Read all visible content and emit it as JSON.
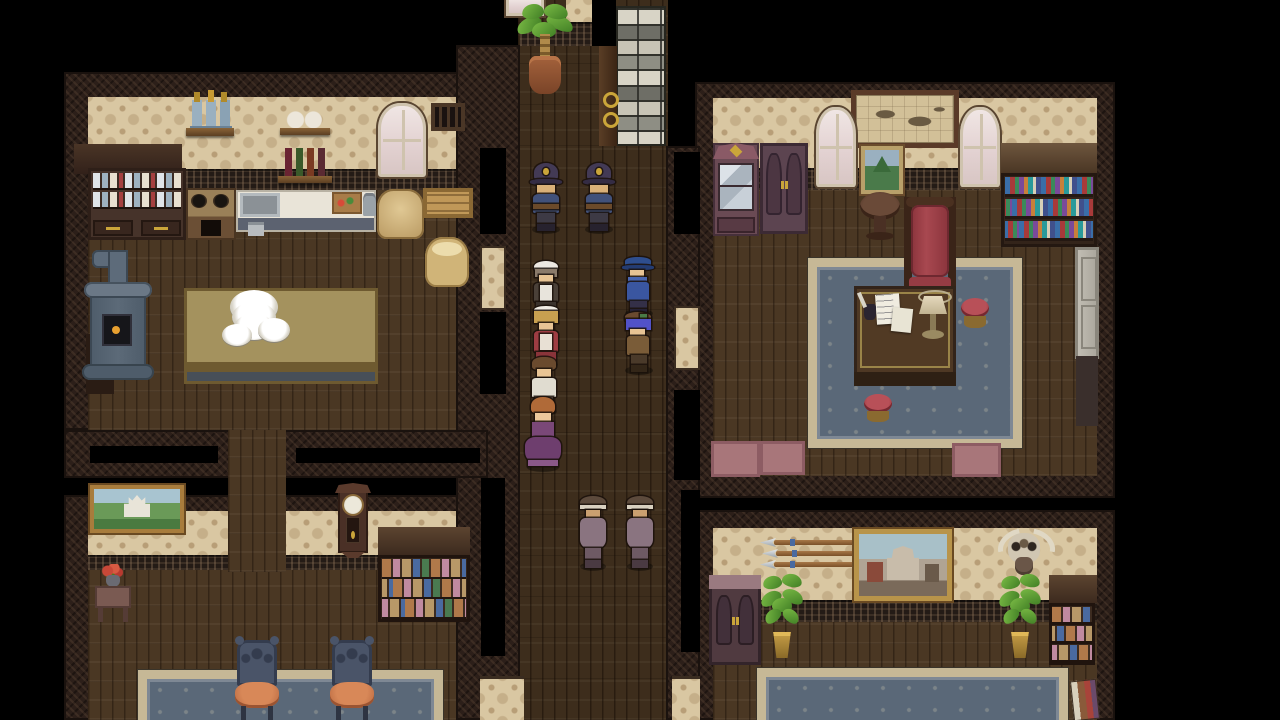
{
  "meta": {
    "app": "retro-rpg-game",
    "scene": "manor-interior-investigation",
    "viewport": "1280x720 fullscreen, no HUD text visible"
  },
  "palette": {
    "letterbox": "#000000",
    "wall_frame": "#2c1f19",
    "wallpaper": "#d9c7a2",
    "wainscot": "#241b16",
    "room_floor": "#4a3723",
    "corridor_floor": "#3d2d1c",
    "rug_blue": "#5a6878",
    "rug_border": "#c6b896",
    "counter_white": "#e9e4d8",
    "table_khaki": "#9c8a58",
    "uniform_navy": "#41517a",
    "detective_blue": "#3a56a0",
    "maid_red": "#9e3c42",
    "gown_purple": "#6e3e6e",
    "cloak_mauve": "#8a7480",
    "brick_light": "#d8d4c6",
    "brick_dark": "#8e8e84",
    "plant_green": "#5aa032",
    "accent_gold": "#caa53a"
  },
  "rooms": [
    {
      "id": "kitchen",
      "label": "kitchen (top-left)"
    },
    {
      "id": "study",
      "label": "study / library (top-right)"
    },
    {
      "id": "dining-room",
      "label": "dining room (bottom-left)"
    },
    {
      "id": "trophy-room",
      "label": "trophy room (bottom-right)"
    },
    {
      "id": "corridor",
      "label": "central corridor"
    }
  ],
  "furniture_inventory": {
    "kitchen": [
      "dish hutch with drawers",
      "wall shelf with jars",
      "wall shelf with pots",
      "wall shelf with wine bottles",
      "arched window",
      "wall vent",
      "stove with burners",
      "counter with sink",
      "cutting board",
      "grain sacks",
      "wooden crate",
      "iron furnace with pipe",
      "large table with plate stacks"
    ],
    "study": [
      "framed wall map",
      "small mountain painting",
      "two arched windows",
      "glass display cabinet",
      "wardrobe",
      "round side table",
      "red high-back chair",
      "bookshelf with books",
      "blue ornate rug",
      "writing desk with papers, ink and lamp",
      "two red stools",
      "grey side door with dark mat",
      "three pink floor mats"
    ],
    "dining-room": [
      "castle painting",
      "grandfather wall clock",
      "toy shelf",
      "side table with red flowers",
      "blue ornate rug",
      "two chairs with orange seats"
    ],
    "trophy-room": [
      "three mounted spears",
      "framed city painting",
      "bull skull trophy",
      "small cabinet",
      "two potted plants",
      "small goods shelf",
      "blue ornate rug",
      "book stack"
    ],
    "corridor": [
      "potted palm",
      "stone brick column",
      "door frame with gold rings"
    ]
  },
  "characters": [
    {
      "id": "police-officer-1",
      "role": "police officer with custodian helmet",
      "x": 528,
      "y": 163,
      "w": 36,
      "h": 68,
      "facing": "down",
      "parts": [
        {
          "name": "helmet",
          "l": 16,
          "t": 0,
          "w": 68,
          "h": 28,
          "c": "#433a55",
          "r": "50% 50% 30% 30%"
        },
        {
          "name": "helmet-brim",
          "l": 5,
          "t": 24,
          "w": 90,
          "h": 9,
          "c": "#342c44",
          "r": "40%"
        },
        {
          "name": "badge",
          "l": 42,
          "t": 7,
          "w": 16,
          "h": 11,
          "c": "#caa53a",
          "r": "50%"
        },
        {
          "name": "face",
          "l": 26,
          "t": 33,
          "w": 48,
          "h": 12,
          "c": "#d9b078"
        },
        {
          "name": "torso",
          "l": 14,
          "t": 45,
          "w": 72,
          "h": 28,
          "c": "#41517a",
          "r": "22% 22% 8% 8%"
        },
        {
          "name": "belt",
          "l": 14,
          "t": 61,
          "w": 72,
          "h": 7,
          "c": "#6b4a2a"
        },
        {
          "name": "legs",
          "l": 25,
          "t": 73,
          "w": 50,
          "h": 18,
          "c": "#3d3a45"
        },
        {
          "name": "boots",
          "l": 25,
          "t": 90,
          "w": 50,
          "h": 10,
          "c": "#27222e"
        }
      ]
    },
    {
      "id": "police-officer-2",
      "role": "police officer with custodian helmet",
      "x": 581,
      "y": 163,
      "w": 36,
      "h": 68,
      "facing": "down",
      "parts": [
        {
          "name": "helmet",
          "l": 16,
          "t": 0,
          "w": 68,
          "h": 28,
          "c": "#433a55",
          "r": "50% 50% 30% 30%"
        },
        {
          "name": "helmet-brim",
          "l": 5,
          "t": 24,
          "w": 90,
          "h": 9,
          "c": "#342c44",
          "r": "40%"
        },
        {
          "name": "badge",
          "l": 42,
          "t": 7,
          "w": 16,
          "h": 11,
          "c": "#caa53a",
          "r": "50%"
        },
        {
          "name": "face",
          "l": 26,
          "t": 33,
          "w": 48,
          "h": 12,
          "c": "#d9b078"
        },
        {
          "name": "torso",
          "l": 14,
          "t": 45,
          "w": 72,
          "h": 28,
          "c": "#41517a",
          "r": "22% 22% 8% 8%"
        },
        {
          "name": "belt",
          "l": 14,
          "t": 61,
          "w": 72,
          "h": 7,
          "c": "#6b4a2a"
        },
        {
          "name": "legs",
          "l": 25,
          "t": 73,
          "w": 50,
          "h": 18,
          "c": "#3d3a45"
        },
        {
          "name": "boots",
          "l": 25,
          "t": 90,
          "w": 50,
          "h": 10,
          "c": "#27222e"
        }
      ]
    },
    {
      "id": "head-maid",
      "role": "older maid with white bonnet",
      "x": 530,
      "y": 261,
      "w": 32,
      "h": 53,
      "facing": "down",
      "parts": [
        {
          "name": "bonnet",
          "l": 12,
          "t": 0,
          "w": 76,
          "h": 22,
          "c": "#ece8e2",
          "r": "50% 50% 40% 40%"
        },
        {
          "name": "hair",
          "l": 16,
          "t": 16,
          "w": 68,
          "h": 15,
          "c": "#8a7a6a"
        },
        {
          "name": "face",
          "l": 28,
          "t": 27,
          "w": 44,
          "h": 14,
          "c": "#e8c494"
        },
        {
          "name": "dress",
          "l": 13,
          "t": 42,
          "w": 74,
          "h": 36,
          "c": "#4a4038",
          "r": "18% 18% 8% 8%"
        },
        {
          "name": "apron",
          "l": 30,
          "t": 46,
          "w": 40,
          "h": 30,
          "c": "#e8e4dc"
        },
        {
          "name": "hem",
          "l": 20,
          "t": 78,
          "w": 60,
          "h": 17,
          "c": "#3a322c"
        }
      ]
    },
    {
      "id": "detective",
      "role": "detective in blue coat and fedora",
      "x": 621,
      "y": 257,
      "w": 36,
      "h": 58,
      "facing": "left",
      "parts": [
        {
          "name": "hat-top",
          "l": 12,
          "t": 0,
          "w": 72,
          "h": 16,
          "c": "#2e4e8e",
          "r": "45% 45% 0 0"
        },
        {
          "name": "hat-brim",
          "l": 2,
          "t": 14,
          "w": 90,
          "h": 8,
          "c": "#243c72",
          "r": "40%"
        },
        {
          "name": "face",
          "l": 24,
          "t": 23,
          "w": 40,
          "h": 13,
          "c": "#e8c494"
        },
        {
          "name": "scarf",
          "l": 20,
          "t": 35,
          "w": 52,
          "h": 10,
          "c": "#4a66b0"
        },
        {
          "name": "coat",
          "l": 16,
          "t": 43,
          "w": 62,
          "h": 33,
          "c": "#3a56a0",
          "r": "15% 15% 10% 10%"
        },
        {
          "name": "legs",
          "l": 26,
          "t": 76,
          "w": 46,
          "h": 15,
          "c": "#343048"
        },
        {
          "name": "boots",
          "l": 26,
          "t": 89,
          "w": 46,
          "h": 11,
          "c": "#262236"
        }
      ]
    },
    {
      "id": "blonde-maid",
      "role": "young maid in crimson uniform",
      "x": 530,
      "y": 306,
      "w": 32,
      "h": 60,
      "facing": "down",
      "parts": [
        {
          "name": "frill",
          "l": 14,
          "t": 0,
          "w": 72,
          "h": 13,
          "c": "#f0ece4",
          "r": "50%"
        },
        {
          "name": "hair",
          "l": 14,
          "t": 8,
          "w": 72,
          "h": 20,
          "c": "#c8a050"
        },
        {
          "name": "face",
          "l": 28,
          "t": 28,
          "w": 44,
          "h": 13,
          "c": "#e8c494"
        },
        {
          "name": "dress",
          "l": 14,
          "t": 42,
          "w": 72,
          "h": 34,
          "c": "#9e3c42",
          "r": "18% 18% 8% 8%"
        },
        {
          "name": "apron",
          "l": 32,
          "t": 46,
          "w": 36,
          "h": 27,
          "c": "#e8e0d4"
        },
        {
          "name": "hem",
          "l": 18,
          "t": 76,
          "w": 64,
          "h": 18,
          "c": "#8a343a"
        }
      ]
    },
    {
      "id": "blue-haired-boy",
      "role": "boy with blue hair, brown cap and jacket",
      "x": 621,
      "y": 312,
      "w": 36,
      "h": 60,
      "facing": "left",
      "parts": [
        {
          "name": "cap",
          "l": 12,
          "t": 0,
          "w": 72,
          "h": 16,
          "c": "#6a4a30",
          "r": "50% 50% 20% 20%"
        },
        {
          "name": "cap-patch",
          "l": 52,
          "t": 4,
          "w": 20,
          "h": 8,
          "c": "#4a7a46"
        },
        {
          "name": "hair",
          "l": 14,
          "t": 12,
          "w": 70,
          "h": 18,
          "c": "#5252c8"
        },
        {
          "name": "face",
          "l": 26,
          "t": 28,
          "w": 40,
          "h": 12,
          "c": "#e8c494"
        },
        {
          "name": "jacket",
          "l": 18,
          "t": 40,
          "w": 60,
          "h": 32,
          "c": "#7a5c38",
          "r": "15% 15% 8% 8%"
        },
        {
          "name": "legs",
          "l": 28,
          "t": 72,
          "w": 44,
          "h": 18,
          "c": "#4a3a2a"
        },
        {
          "name": "boots",
          "l": 28,
          "t": 89,
          "w": 44,
          "h": 11,
          "c": "#332618"
        }
      ]
    },
    {
      "id": "butler-man",
      "role": "man with brown hair and white shirt",
      "x": 527,
      "y": 357,
      "w": 34,
      "h": 56,
      "facing": "down",
      "parts": [
        {
          "name": "hair",
          "l": 16,
          "t": 0,
          "w": 68,
          "h": 24,
          "c": "#6a4a2e",
          "r": "45% 45% 25% 25%"
        },
        {
          "name": "face",
          "l": 28,
          "t": 22,
          "w": 44,
          "h": 14,
          "c": "#e8c494"
        },
        {
          "name": "shirt",
          "l": 14,
          "t": 38,
          "w": 72,
          "h": 34,
          "c": "#e0dcd0",
          "r": "15% 15% 5% 5%"
        },
        {
          "name": "legs",
          "l": 24,
          "t": 72,
          "w": 52,
          "h": 20,
          "c": "#4a3a30"
        }
      ]
    },
    {
      "id": "lady-purple-gown",
      "role": "lady with auburn updo in purple gown",
      "x": 522,
      "y": 397,
      "w": 42,
      "h": 72,
      "facing": "down",
      "parts": [
        {
          "name": "hair",
          "l": 22,
          "t": 0,
          "w": 56,
          "h": 24,
          "c": "#b06a38",
          "r": "50% 50% 30% 30%"
        },
        {
          "name": "face",
          "l": 30,
          "t": 22,
          "w": 40,
          "h": 13,
          "c": "#ecc89c"
        },
        {
          "name": "bodice",
          "l": 24,
          "t": 35,
          "w": 52,
          "h": 22,
          "c": "#7a4878"
        },
        {
          "name": "skirt",
          "l": 8,
          "t": 55,
          "w": 84,
          "h": 40,
          "c": "#6e3e6e",
          "r": "30% 30% 45% 45%"
        },
        {
          "name": "skirt-trim",
          "l": 14,
          "t": 88,
          "w": 72,
          "h": 8,
          "c": "#8a5888"
        }
      ]
    },
    {
      "id": "cloaked-figure-1",
      "role": "cloaked figure with banded hat",
      "x": 576,
      "y": 496,
      "w": 34,
      "h": 72,
      "facing": "down",
      "parts": [
        {
          "name": "hat",
          "l": 12,
          "t": 0,
          "w": 76,
          "h": 18,
          "c": "#5c4a3c",
          "r": "50% 50% 30% 30%"
        },
        {
          "name": "hat-band",
          "l": 12,
          "t": 13,
          "w": 76,
          "h": 5,
          "c": "#d8d0c0"
        },
        {
          "name": "face",
          "l": 28,
          "t": 19,
          "w": 44,
          "h": 11,
          "c": "#caa070"
        },
        {
          "name": "cloak",
          "l": 12,
          "t": 30,
          "w": 76,
          "h": 42,
          "c": "#8a7480",
          "r": "20% 20% 28% 28%"
        },
        {
          "name": "legs",
          "l": 26,
          "t": 72,
          "w": 48,
          "h": 18,
          "c": "#6e5a64"
        },
        {
          "name": "boots",
          "l": 26,
          "t": 89,
          "w": 48,
          "h": 11,
          "c": "#4a3a42"
        }
      ]
    },
    {
      "id": "cloaked-figure-2",
      "role": "cloaked figure with banded hat",
      "x": 623,
      "y": 496,
      "w": 34,
      "h": 72,
      "facing": "down",
      "parts": [
        {
          "name": "hat",
          "l": 12,
          "t": 0,
          "w": 76,
          "h": 18,
          "c": "#5c4a3c",
          "r": "50% 50% 30% 30%"
        },
        {
          "name": "hat-band",
          "l": 12,
          "t": 13,
          "w": 76,
          "h": 5,
          "c": "#d8d0c0"
        },
        {
          "name": "face",
          "l": 28,
          "t": 19,
          "w": 44,
          "h": 11,
          "c": "#caa070"
        },
        {
          "name": "cloak",
          "l": 12,
          "t": 30,
          "w": 76,
          "h": 42,
          "c": "#8a7480",
          "r": "20% 20% 28% 28%"
        },
        {
          "name": "legs",
          "l": 26,
          "t": 72,
          "w": 48,
          "h": 18,
          "c": "#6e5a64"
        },
        {
          "name": "boots",
          "l": 26,
          "t": 89,
          "w": 48,
          "h": 11,
          "c": "#4a3a42"
        }
      ]
    }
  ]
}
